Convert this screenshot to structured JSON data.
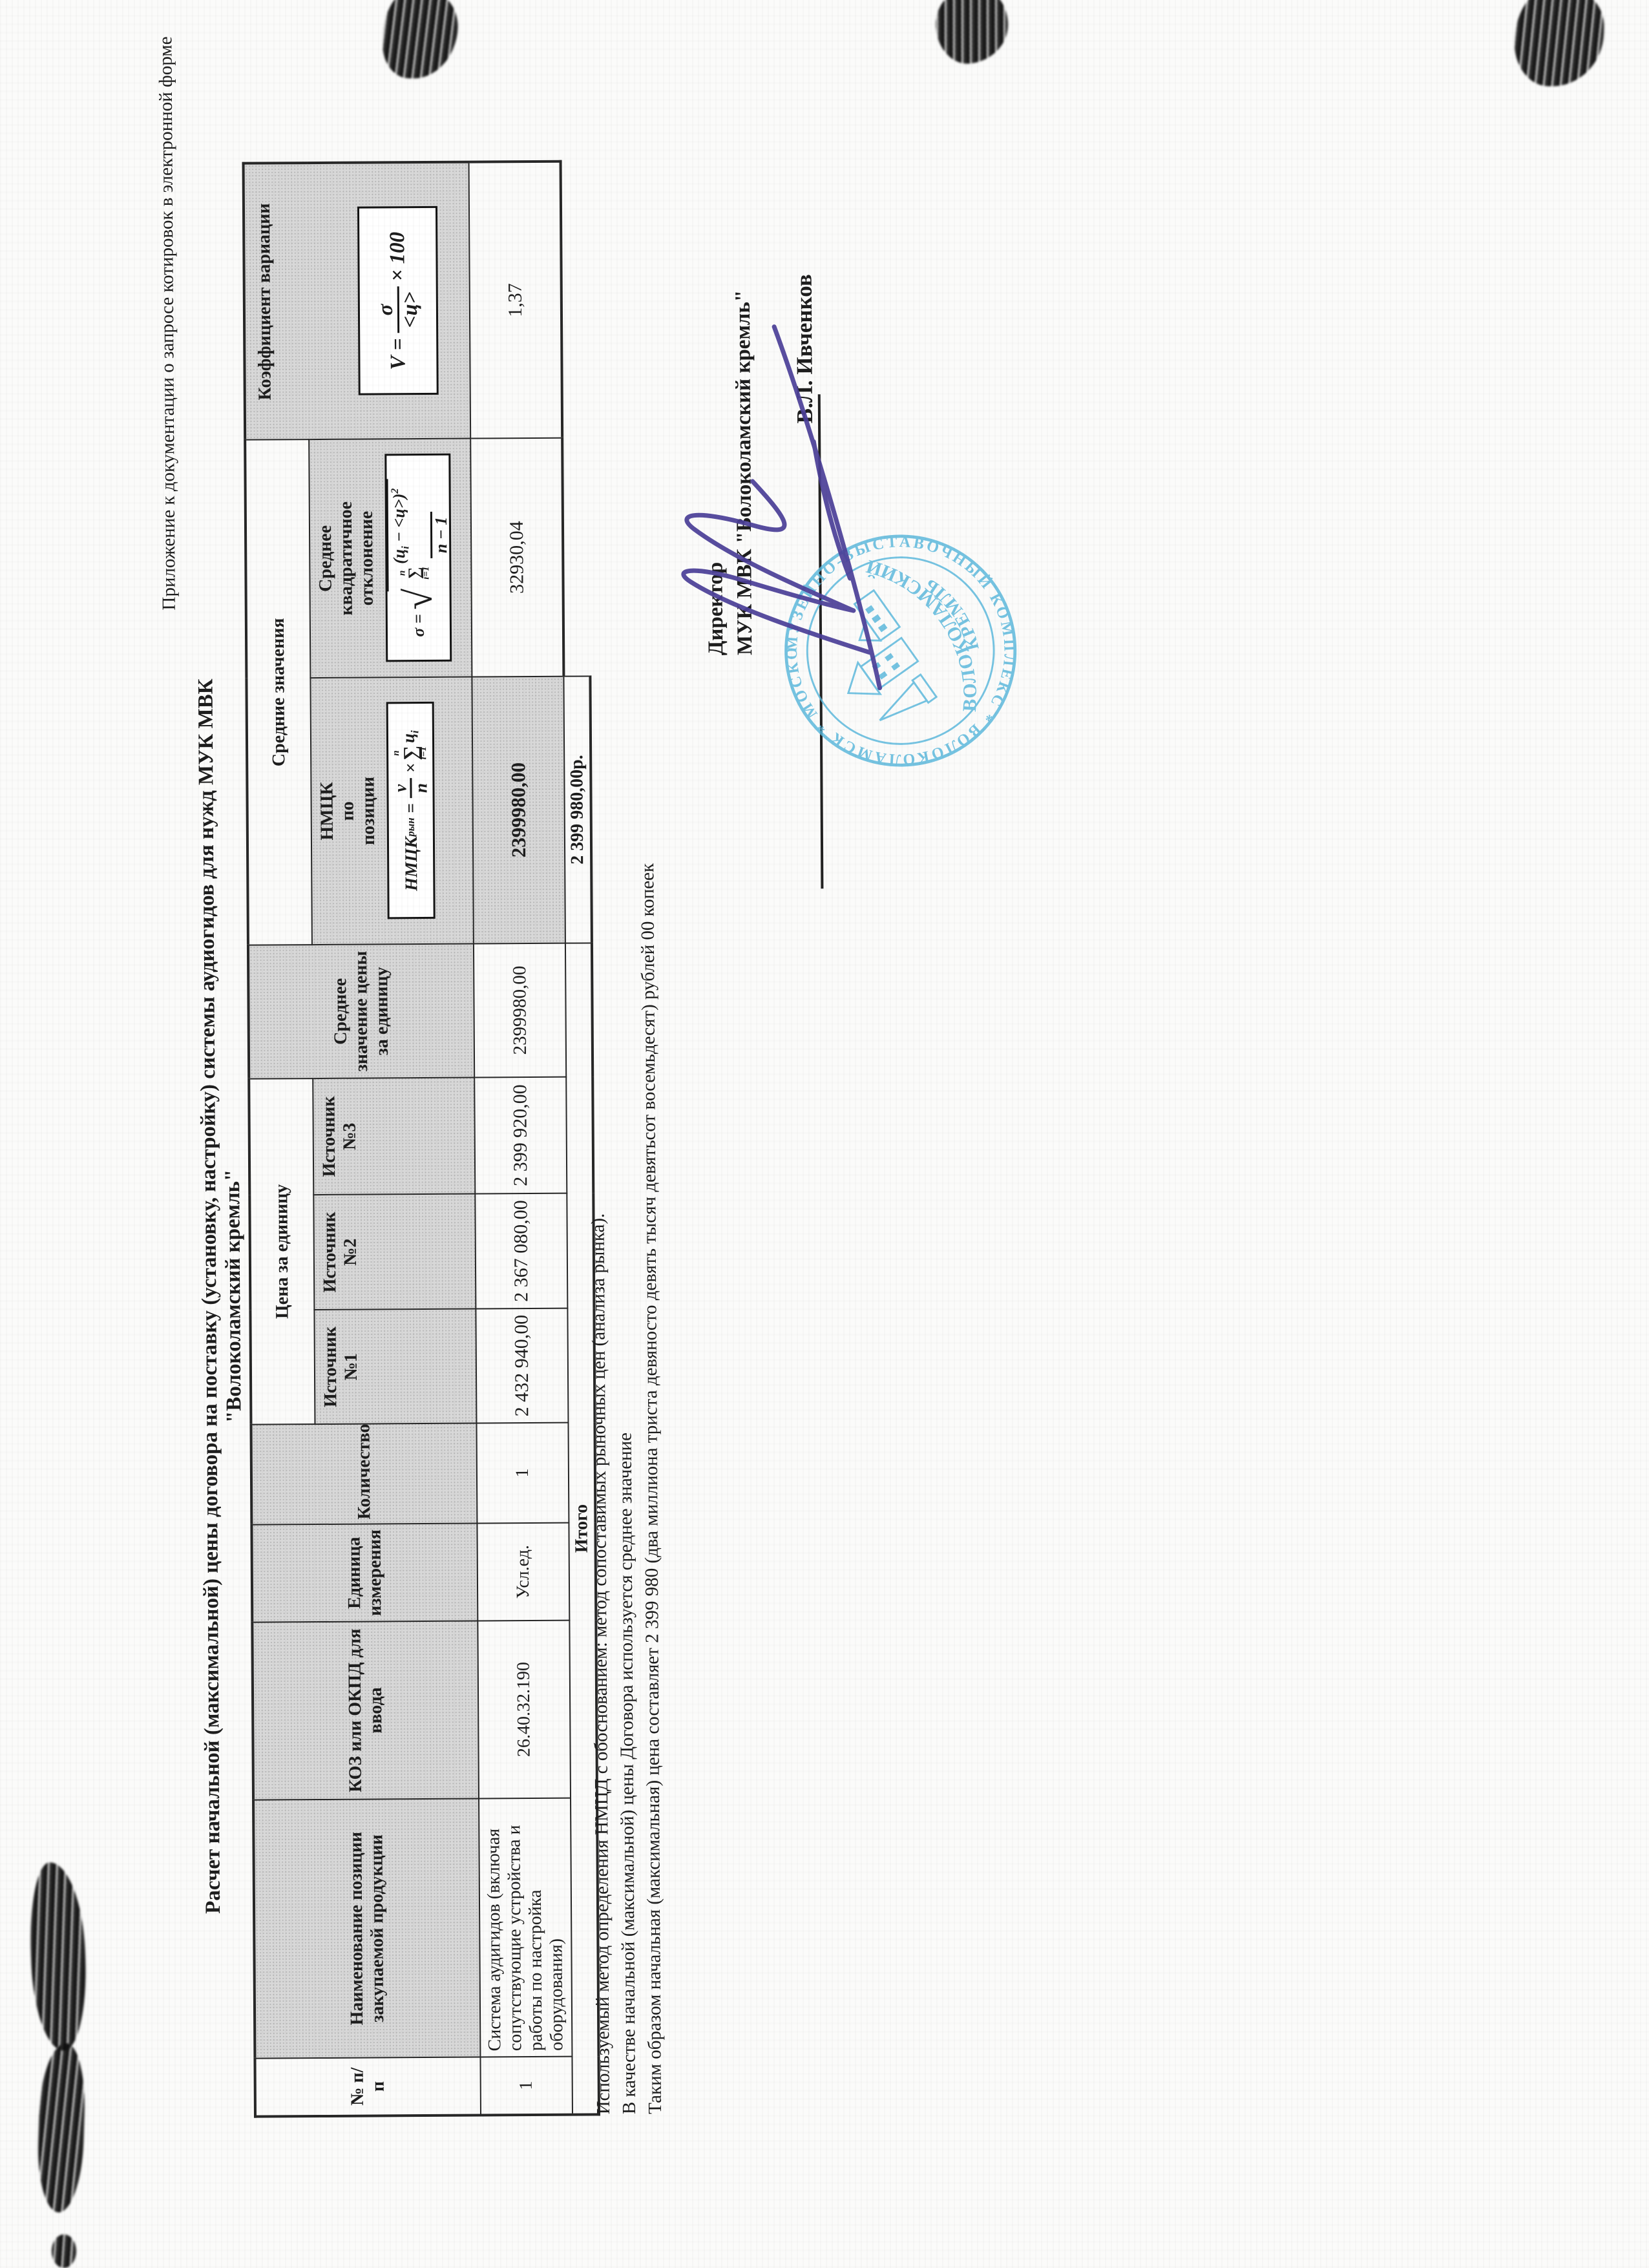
{
  "colors": {
    "cell_shade": "#d8d8d8",
    "stamp_blue": "#58b7dc",
    "signature_ink": "#4b3f98",
    "border": "#272727"
  },
  "page": {
    "corner_note": "Приложение к документации о запросе котировок в электронной форме",
    "title": "Расчет начальной (максимальной) цены договора на поставку (установку, настройку) системы аудиогидов для нужд МУК МВК \"Волоколамский кремль\""
  },
  "table": {
    "headers": {
      "num": "№ п/п",
      "name": "Наименование позиции закупаемой продукции",
      "code": "КОЗ или ОКПД для ввода",
      "unit": "Единица измерения",
      "qty": "Количество",
      "price_group": "Цена за единицу",
      "src1": "Источник №1",
      "src2": "Источник №2",
      "src3": "Источник №3",
      "avg_price": "Среднее значение цены за единицу",
      "avg_group": "Средние значения",
      "nmck": "НМЦК по позиции",
      "stddev": "Среднее квадратичное отклонение",
      "varcoef": "Коэффициент вариации"
    },
    "row": {
      "num": "1",
      "name": "Система аудигидов (включая сопутствующие устройства и работы по настройка оборудования)",
      "code": "26.40.32.190",
      "unit": "Усл.ед.",
      "qty": "1",
      "src1": "2 432 940,00",
      "src2": "2 367 080,00",
      "src3": "2 399 920,00",
      "avg_price": "2399980,00",
      "nmck": "2399980,00",
      "stddev": "32930,04",
      "varcoef": "1,37"
    },
    "total_label": "Итого",
    "total_value": "2 399 980,00р."
  },
  "formulas": {
    "nmck": {
      "lhs": "НМЦК",
      "sup": "рын",
      "eq": "=",
      "num": "v",
      "den": "n",
      "times": "×",
      "sum": "∑",
      "sum_sup": "n",
      "sum_sub": "i=1",
      "term": "ц",
      "term_sub": "i"
    },
    "sigma": {
      "lhs": "σ",
      "eq": "=",
      "sum": "∑",
      "sum_sup": "n",
      "sum_sub": "i=1",
      "expr_open": "(ц",
      "expr_i": "i",
      "expr_close": " − <ц>)",
      "sq": "2",
      "den": "n − 1"
    },
    "v": {
      "lhs": "V",
      "eq": "=",
      "num": "σ",
      "den": "<ц>",
      "factor": "× 100"
    }
  },
  "notes": [
    "Используемый метод определения НМЦД с обоснованием: метод сопоставимых рыночных цен (анализа рынка).",
    "В качестве начальной (максимальной) цены Договора используется среднее значение",
    "Таким образом начальная (максимальная) цена составляет 2 399 980 (два миллиона триста девяносто девять тысяч девятьсот восемьдесят) рублей 00 копеек"
  ],
  "signature": {
    "role_line1": "Директор",
    "role_line2": "МУК МВК \"Волоколамский кремль\"",
    "name": "В.Л. Ивченков"
  },
  "stamp": {
    "ring_text": "МУЗЕЙНО-ВЫСТАВОЧНЫЙ КОМПЛЕКС  *  ВОЛОКОЛАМСК  *  МОСКОВСКАЯ обл.  *",
    "center_line1": "ВОЛОКОЛАМСКИЙ",
    "center_line2": "КРЕМЛЬ"
  }
}
